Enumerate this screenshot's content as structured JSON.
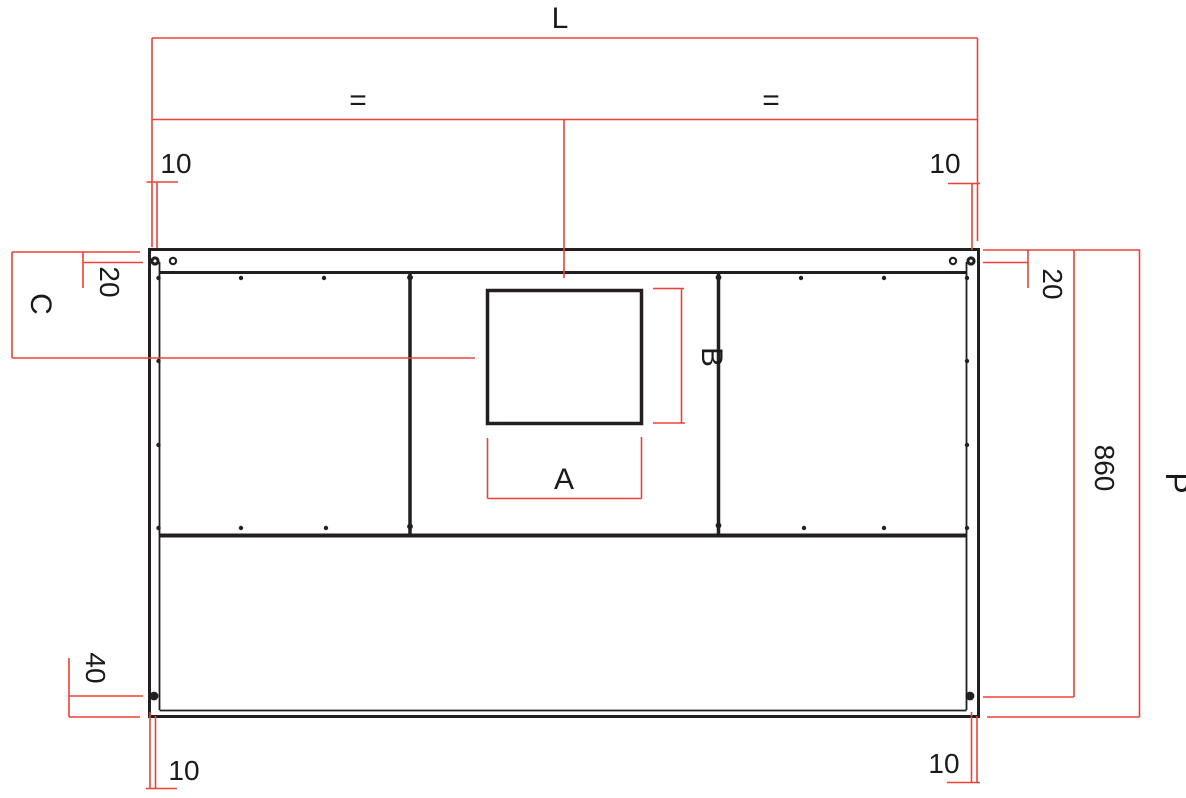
{
  "drawing": {
    "title": "panel technical drawing",
    "labels": {
      "overall_width": "L",
      "equal_left": "=",
      "equal_right": "=",
      "hole_offset_top_left": "10",
      "hole_offset_top_right": "10",
      "hole_edge_top_left": "20",
      "hole_edge_top_right": "20",
      "cutout_center_from_top": "C",
      "cutout_width": "A",
      "cutout_height": "B",
      "inner_height": "860",
      "overall_height": "P",
      "hole_edge_bottom": "40",
      "hole_offset_bottom_left": "10",
      "hole_offset_bottom_right": "10"
    },
    "colors": {
      "dimension_red": "#ee4035",
      "outline_black": "#231f20",
      "background": "#ffffff"
    }
  }
}
